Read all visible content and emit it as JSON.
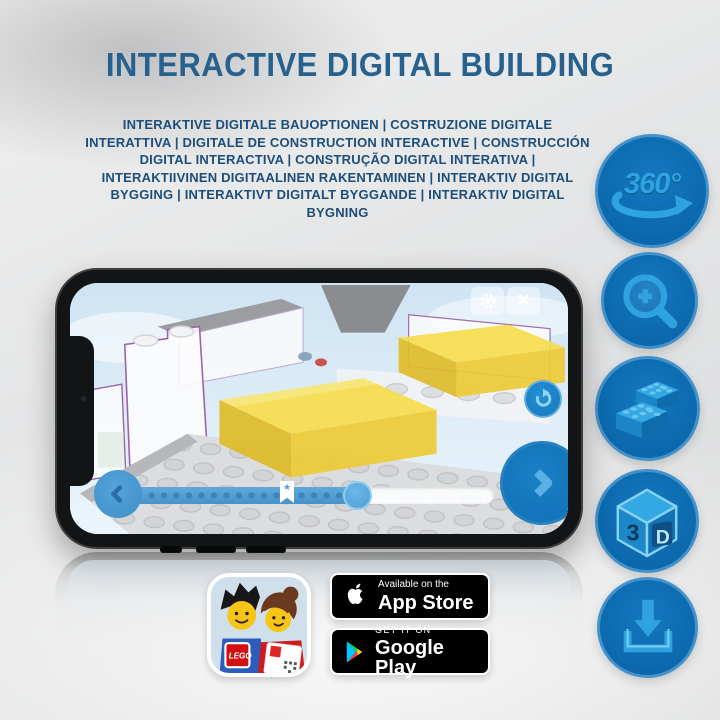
{
  "header": {
    "title": "INTERACTIVE DIGITAL BUILDING"
  },
  "subtitle": {
    "text": "INTERAKTIVE DIGITALE BAUOPTIONEN | COSTRUZIONE DIGITALE INTERATTIVA | DIGITALE DE CONSTRUCTION INTERACTIVE | CONSTRUCCIÓN DIGITAL INTERACTIVA | CONSTRUÇÃO DIGITAL INTERATIVA | INTERAKTIIVINEN DIGITAALINEN RAKENTAMINEN | INTERAKTIV DIGITAL BYGGING | INTERAKTIVT DIGITALT BYGGANDE | INTERAKTIV DIGITAL BYGNING"
  },
  "features": [
    {
      "id": "rotate-360",
      "label": "360°"
    },
    {
      "id": "zoom-in"
    },
    {
      "id": "lego-bricks"
    },
    {
      "id": "cube-3d",
      "face_left": "3",
      "face_right": "D"
    },
    {
      "id": "download"
    }
  ],
  "phone": {
    "screen_content": "3D LEGO building step with highlighted yellow pieces",
    "progress": {
      "value_pct": 62,
      "marker_pct": 43,
      "marker_icon": "★"
    },
    "controls": {
      "close_icon": "✕"
    }
  },
  "store_badges": {
    "app_store": {
      "line1": "Available on the",
      "line2": "App Store"
    },
    "google_play": {
      "line1": "GET IT ON",
      "line2": "Google Play"
    }
  },
  "app_icon": {
    "logo_text": "LEGO"
  },
  "colors": {
    "title_blue": "#27618d",
    "circle_blue": "#0d6cb0",
    "glyph_blue": "#2fa3e0",
    "screen_sky": "#d7e9f5",
    "highlight_yellow": "#f6dd4f"
  }
}
